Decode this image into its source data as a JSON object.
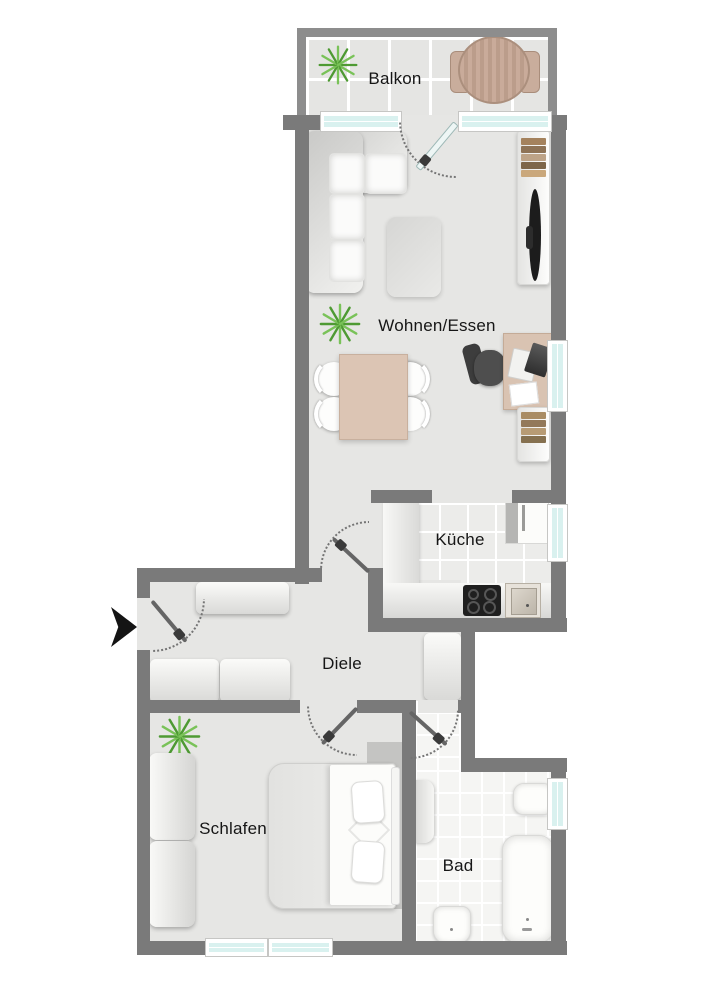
{
  "labels": {
    "balkon": "Balkon",
    "wohnen": "Wohnen/Essen",
    "kueche": "Küche",
    "diele": "Diele",
    "schlafen": "Schlafen",
    "bad": "Bad"
  },
  "colors": {
    "wall": "#7a7a7a",
    "balcony_wall": "#8d8d8d",
    "floor": "#e6e6e4",
    "tile_kitchen": "#ececea",
    "tile_bath": "#f5f5f3",
    "tile_balcony": "#e5e5e3",
    "window_glass": "#d9f1ef",
    "wood": "#d9c3b3",
    "balcony_wood": "#c9ab9a",
    "plant_dark": "#4e9a33",
    "plant_light": "#79c258",
    "dark_appliance": "#1f1f1f"
  },
  "furniture": [
    "sofa",
    "coffee-table",
    "dining-table",
    "dining-chair",
    "desk",
    "office-chair",
    "laptop",
    "paper",
    "sideboard",
    "books",
    "tv",
    "plant",
    "balcony-table",
    "balcony-chair",
    "kitchen-counter",
    "cooktop",
    "sink",
    "fridge",
    "wardrobe",
    "hall-cabinet",
    "bed",
    "pillow",
    "washing-machine",
    "washbasin",
    "bathtub",
    "toilet",
    "entrance-arrow",
    "door",
    "window"
  ]
}
